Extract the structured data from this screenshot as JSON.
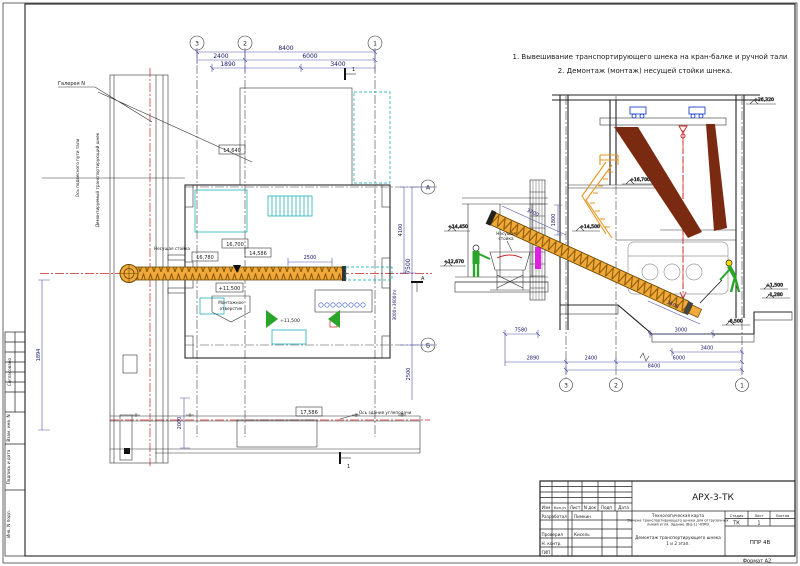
{
  "notes": {
    "line1": "1. Вывешивание транспортирующего шнека на кран-балке и ручной тали",
    "line2": "2. Демонтаж (монтаж) несущей стойки шнека."
  },
  "plan": {
    "grid": {
      "g3": "3",
      "g2": "2",
      "g1": "1",
      "gA": "А",
      "gB": "Б"
    },
    "dims": {
      "total": "8400",
      "d2400": "2400",
      "d6000": "6000",
      "d1890": "1890",
      "d3400": "3400",
      "d2500top": "2500",
      "v7500": "7500",
      "v4100": "4100",
      "opening": "3000×3600(h)",
      "v2500": "2500",
      "v1894": "1894",
      "v2000": "2000"
    },
    "labels": {
      "gallery": "Галерея N",
      "rail_axis": "Ось подвесного пути тали",
      "screw_note": "Демонтируемый транспортирующий шнек",
      "stand": "Несущая стойка",
      "e14640": "14,640",
      "e16700": "16,700",
      "e16780": "16,780",
      "e14586": "14,586",
      "e11500a": "+11,500",
      "e11500b": "+11,500",
      "e17586": "17,586",
      "opening_note1": "Монтажное",
      "opening_note2": "отверстие",
      "axis_note": "Ось здания углеподачи",
      "sec1": "1",
      "secA": "А"
    }
  },
  "section": {
    "grid": {
      "g3": "3",
      "g2": "2",
      "g1": "1"
    },
    "dims": {
      "d7580": "7580",
      "d3000": "3000",
      "d3400": "3400",
      "d2890": "2890",
      "d2400": "2400",
      "d6000": "6000",
      "d8400": "8400",
      "d1800": "1800",
      "d3700": "3700",
      "d3500": "3500"
    },
    "elev": {
      "top": "+26,320",
      "e16700": "+16,700",
      "e14500": "+14,500",
      "e14450": "+14,450",
      "e12670": "+12,670",
      "e1500": "+1,500",
      "em1280": "-1,280",
      "em6500": "-6,500"
    },
    "labels": {
      "stand1": "Несущая",
      "stand2": "стойка"
    }
  },
  "titleblock": {
    "code": "АРХ-3-ТК",
    "h_izm": "Изм",
    "h_koluch": "Кол.уч",
    "h_list": "Лист",
    "h_ndok": "N док",
    "h_podp": "Подп",
    "h_data": "Дата",
    "r1_role": "Разработал",
    "r1_name": "Пимкин",
    "r2_role": "Проверил",
    "r2_name": "Кисель",
    "r3_role": "Н. контр.",
    "r4_role": "ГИП",
    "doc_type": "Технологическая карта",
    "doc_name1": "Замена транспортирующего шнека для отгрузочных",
    "doc_name2": "линий угля. Здание (ВЦ-1) ЧЛМЗ",
    "h_stage": "Стадия",
    "h_sheet": "Лист",
    "h_sheets": "Листов",
    "stage": "ТК",
    "sheet": "1",
    "sheet_name1": "Демонтаж транспортирующего шнека",
    "sheet_name2": "1 и 2 этап.",
    "org": "ППР 4В"
  },
  "side_stamp": {
    "agreed": "Согласовано",
    "vzam": "Взам. инв. N",
    "podp": "Подпись и дата",
    "inv": "Инв. N подл."
  },
  "frame": {
    "format": "Формат А2"
  }
}
